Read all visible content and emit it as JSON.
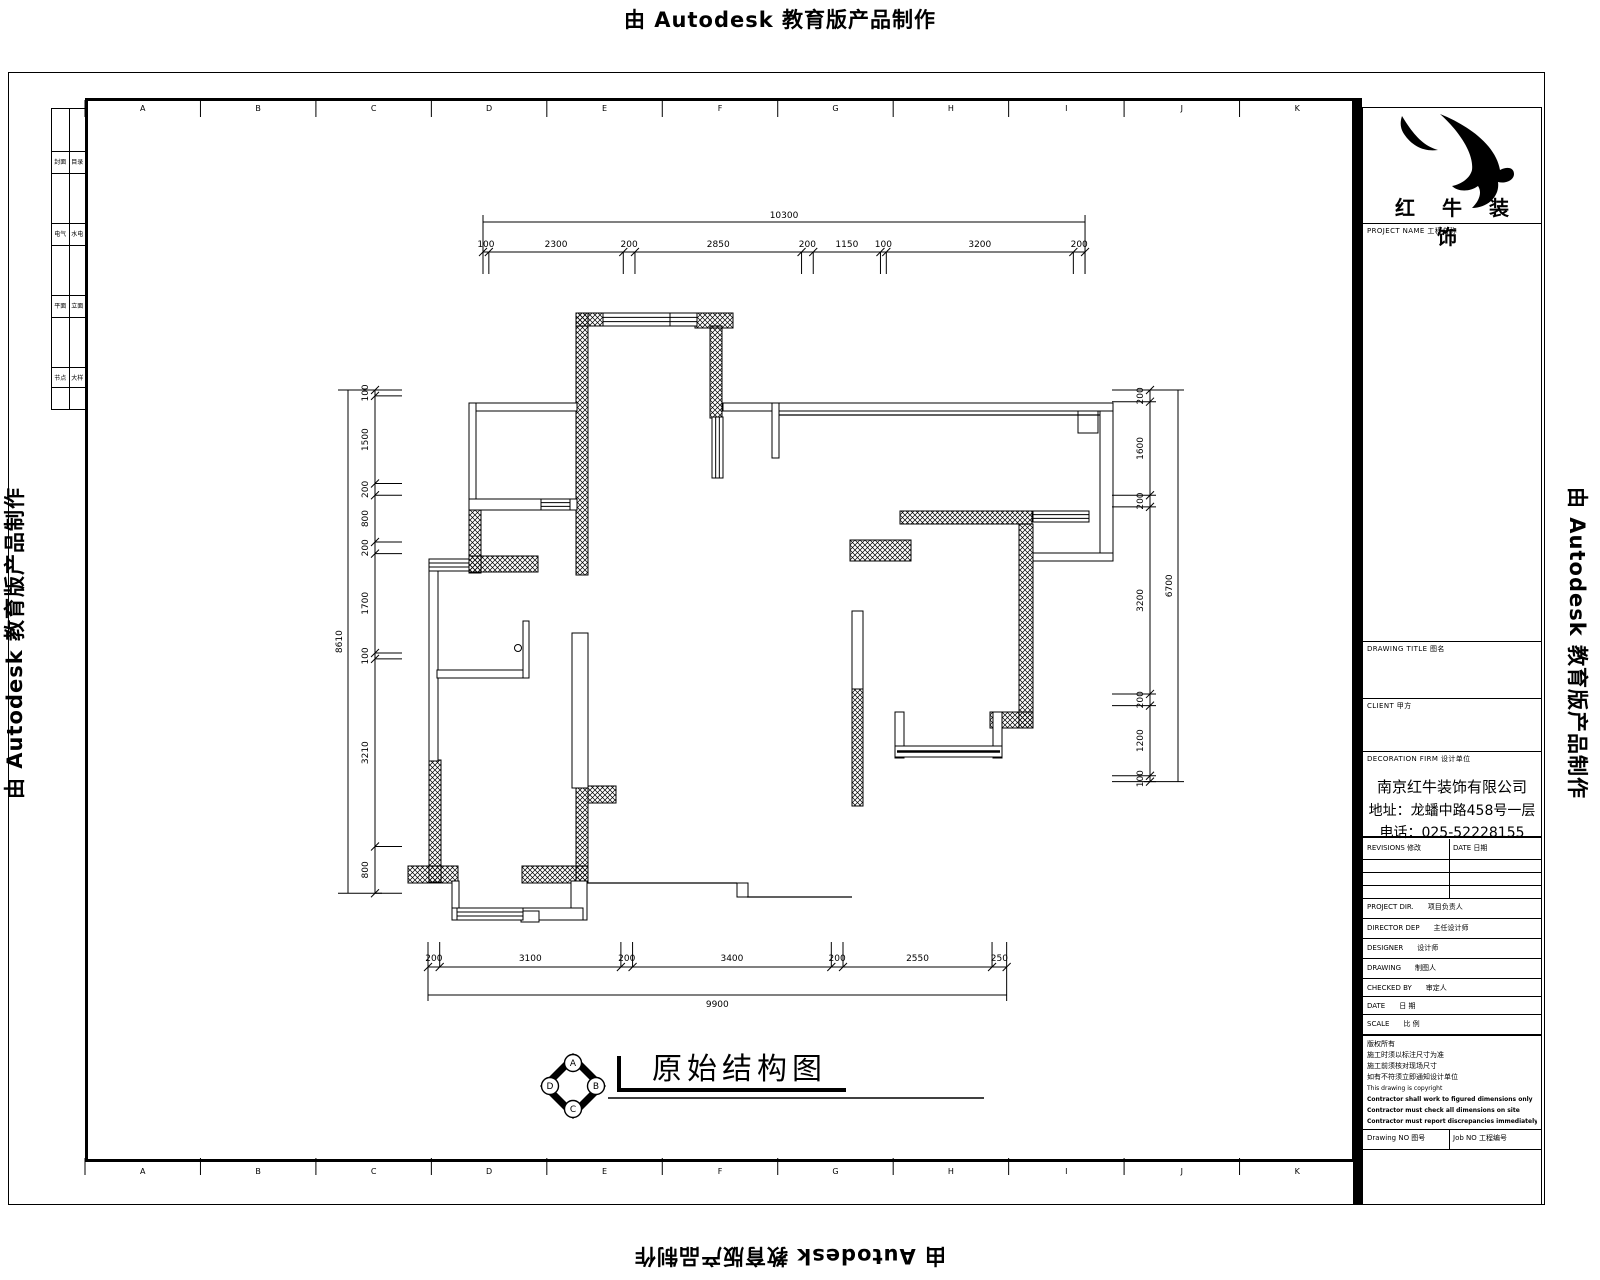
{
  "watermark": {
    "text": "由 Autodesk 教育版产品制作"
  },
  "drawing_title": "原始结构图",
  "grid_letters": [
    "A",
    "B",
    "C",
    "D",
    "E",
    "F",
    "G",
    "H",
    "I",
    "J",
    "K"
  ],
  "compass": {
    "letters": [
      "A",
      "B",
      "C",
      "D"
    ]
  },
  "sheet_index": {
    "rows": [
      [
        "封面",
        "目录"
      ],
      [
        "电气",
        "水电"
      ],
      [
        "平面",
        "立面"
      ],
      [
        "节点",
        "大样"
      ]
    ]
  },
  "title_block": {
    "logo_text": "红 牛 装 饰",
    "project_label": "PROJECT NAME 工程名称",
    "drawing_title_label": "DRAWING TITLE 图名",
    "client_label": "CLIENT 甲方",
    "firm_label": "DECORATION FIRM 设计单位",
    "company": {
      "name": "南京红牛装饰有限公司",
      "address": "地址：龙蟠中路458号一层",
      "phone": "电话：025-52228155"
    },
    "revisions": {
      "left": "REVISIONS 修改",
      "right": "DATE 日期"
    },
    "fields": [
      {
        "en": "PROJECT DIR.",
        "zh": "项目负责人"
      },
      {
        "en": "DIRECTOR DEP",
        "zh": "主任设计师"
      },
      {
        "en": "DESIGNER",
        "zh": "设计师"
      },
      {
        "en": "DRAWING",
        "zh": "制图人"
      },
      {
        "en": "CHECKED BY",
        "zh": "审定人"
      },
      {
        "en": "DATE",
        "zh": "日 期"
      },
      {
        "en": "SCALE",
        "zh": "比 例"
      }
    ],
    "notes": [
      {
        "text": "版权所有",
        "bold": false,
        "en": false
      },
      {
        "text": "施工时须以标注尺寸为准",
        "bold": false,
        "en": false
      },
      {
        "text": "施工前须核对现场尺寸",
        "bold": false,
        "en": false
      },
      {
        "text": "如有不符须立即通知设计单位",
        "bold": false,
        "en": false
      },
      {
        "text": "This drawing is copyright",
        "bold": false,
        "en": true
      },
      {
        "text": "Contractor shall work to figured dimensions only",
        "bold": true,
        "en": true
      },
      {
        "text": "Contractor must check all dimensions on site",
        "bold": true,
        "en": true
      },
      {
        "text": "Contractor must report discrepancies immediately to architect",
        "bold": true,
        "en": true
      }
    ],
    "footer": {
      "left": "Drawing NO 图号",
      "right": "Job NO 工程编号"
    }
  },
  "dimensions": {
    "top": {
      "overall": "10300",
      "segments": [
        100,
        2300,
        200,
        2850,
        200,
        1150,
        100,
        3200,
        200
      ]
    },
    "bottom": {
      "overall": "9900",
      "segments": [
        200,
        3100,
        200,
        3400,
        200,
        2550,
        250
      ]
    },
    "left": {
      "overall": "8610",
      "segments": [
        100,
        1500,
        200,
        800,
        200,
        1700,
        100,
        3210,
        800
      ]
    },
    "right": {
      "overall": "6700",
      "segments": [
        200,
        1600,
        200,
        3200,
        200,
        1200,
        100
      ]
    }
  },
  "plan": {
    "hatched": [
      [
        576,
        313,
        12,
        262
      ],
      [
        576,
        313,
        28,
        13
      ],
      [
        695,
        313,
        38,
        15
      ],
      [
        710,
        326,
        12,
        92
      ],
      [
        469,
        499,
        12,
        74
      ],
      [
        469,
        556,
        69,
        16
      ],
      [
        429,
        760,
        12,
        122
      ],
      [
        408,
        866,
        50,
        17
      ],
      [
        522,
        866,
        66,
        17
      ],
      [
        576,
        786,
        12,
        97
      ],
      [
        588,
        786,
        28,
        17
      ],
      [
        852,
        688,
        11,
        118
      ],
      [
        900,
        511,
        132,
        13
      ],
      [
        1019,
        524,
        14,
        204
      ],
      [
        990,
        712,
        43,
        16
      ],
      [
        850,
        540,
        61,
        21
      ]
    ],
    "thin": [
      [
        469,
        403,
        108,
        8
      ],
      [
        469,
        403,
        7,
        96
      ],
      [
        469,
        499,
        108,
        11
      ],
      [
        723,
        403,
        390,
        8
      ],
      [
        772,
        403,
        7,
        55
      ],
      [
        1078,
        411,
        20,
        22
      ],
      [
        1100,
        411,
        13,
        150
      ],
      [
        1033,
        553,
        80,
        8
      ],
      [
        895,
        712,
        9,
        46
      ],
      [
        993,
        712,
        9,
        46
      ],
      [
        572,
        633,
        16,
        155
      ],
      [
        429,
        571,
        9,
        190
      ],
      [
        452,
        881,
        7,
        39
      ],
      [
        571,
        881,
        16,
        39
      ],
      [
        452,
        908,
        131,
        12
      ],
      [
        521,
        911,
        18,
        11
      ],
      [
        437,
        670,
        87,
        8
      ],
      [
        852,
        611,
        11,
        78
      ],
      [
        737,
        883,
        11,
        14
      ]
    ],
    "lines": [
      [
        [
          587,
          883
        ],
        [
          737,
          883
        ]
      ],
      [
        [
          747,
          897
        ],
        [
          852,
          897
        ]
      ],
      [
        [
          779,
          415
        ],
        [
          1100,
          415
        ]
      ]
    ],
    "windows": [
      [
        603,
        313,
        67,
        13,
        "h"
      ],
      [
        670,
        313,
        27,
        13,
        "h"
      ],
      [
        541,
        499,
        29,
        11,
        "h"
      ],
      [
        457,
        908,
        66,
        12,
        "h"
      ],
      [
        1033,
        511,
        56,
        11,
        "h"
      ],
      [
        712,
        417,
        11,
        61,
        "v"
      ],
      [
        895,
        746,
        107,
        11,
        "hb"
      ],
      [
        429,
        559,
        40,
        12,
        "h"
      ]
    ],
    "door": {
      "leaf": [
        523,
        621,
        6,
        57
      ],
      "knob": [
        518,
        648,
        3.5
      ]
    }
  },
  "colors": {
    "line": "#000000",
    "background": "#ffffff"
  }
}
